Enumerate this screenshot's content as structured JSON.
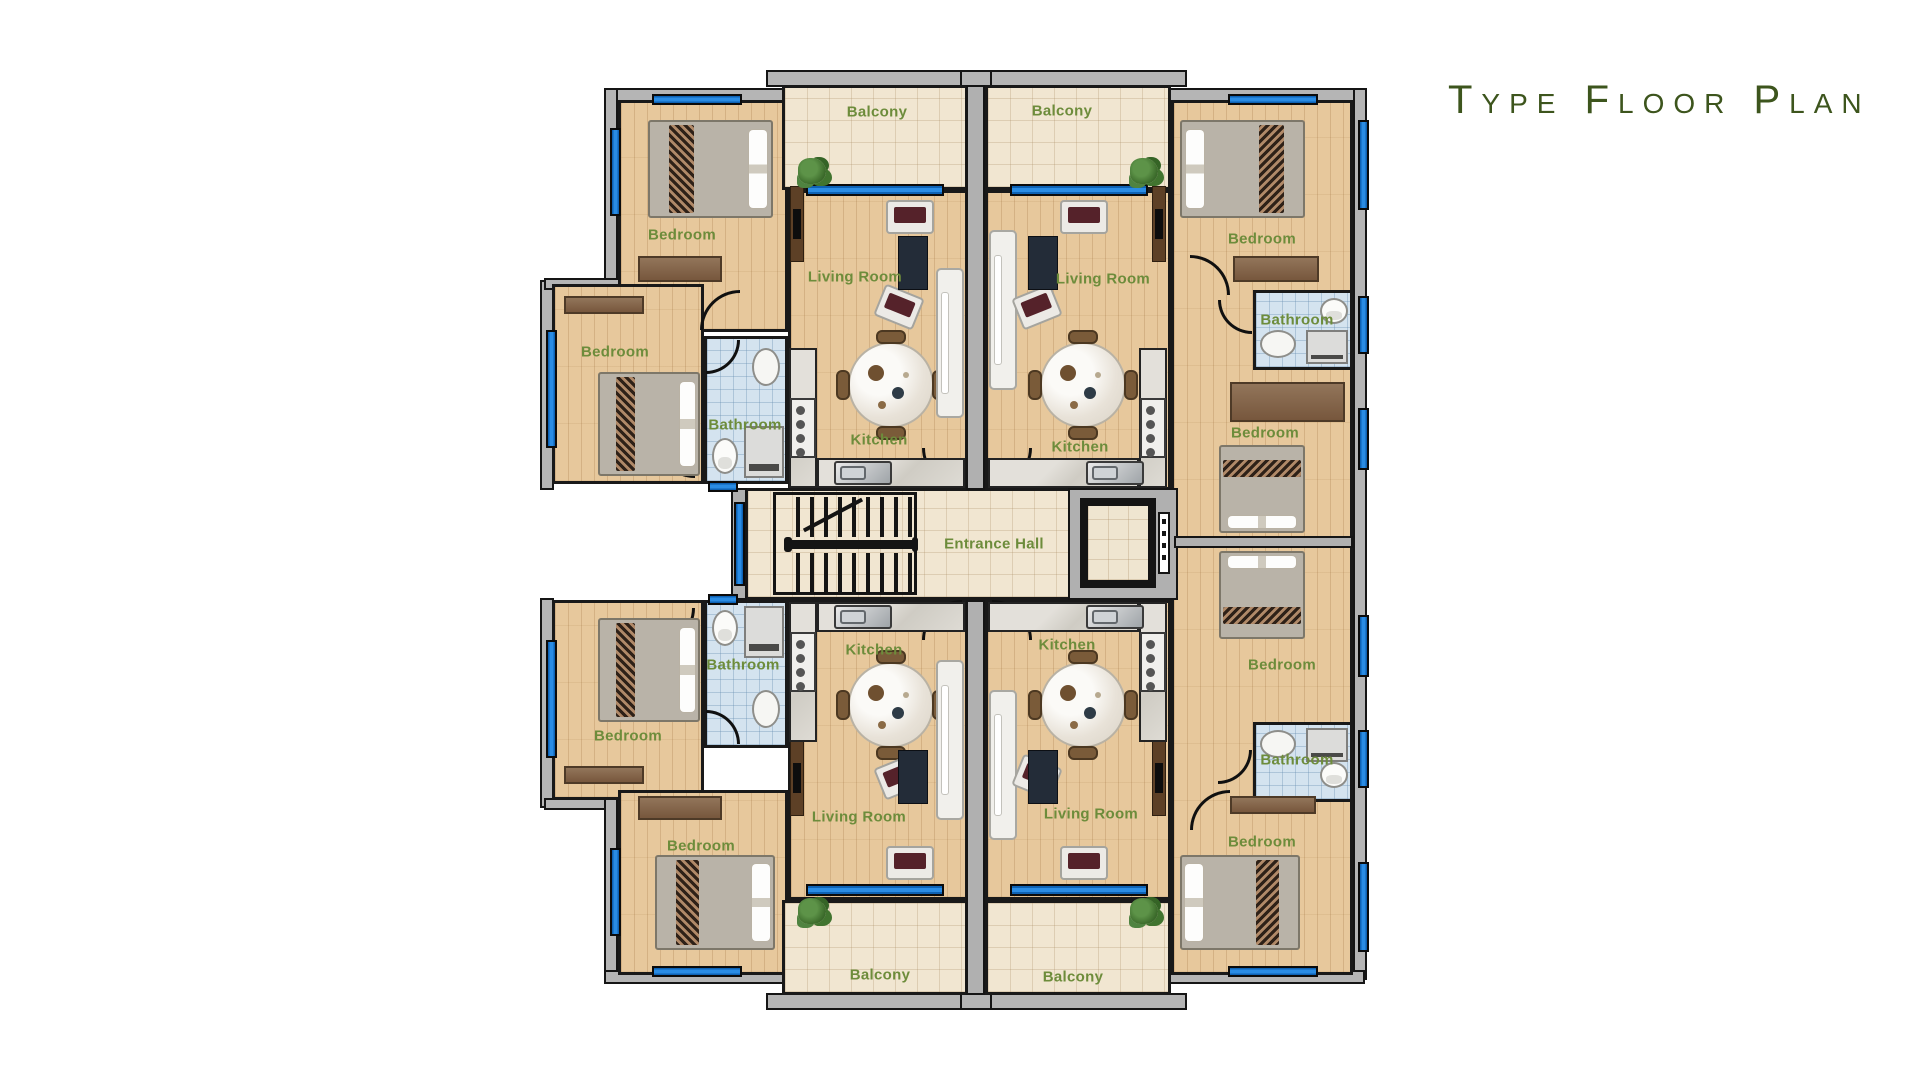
{
  "title": "Type Floor Plan",
  "rooms": {
    "balcony": "Balcony",
    "bedroom": "Bedroom",
    "bathroom": "Bathroom",
    "kitchen": "Kitchen",
    "living_room": "Living Room",
    "entrance_hall": "Entrance Hall"
  },
  "counts": {
    "balconies": 4,
    "bedrooms": 8,
    "bathrooms": 4,
    "kitchens": 4,
    "living_rooms": 4,
    "entrance_halls": 1
  },
  "colors": {
    "label_green": "#6d8c3b",
    "title_green": "#3d551d",
    "window_blue": "#2a8ce4",
    "wood_floor": "#e7c89c",
    "tile_cream": "#f1e6d1",
    "tile_bathroom_blue": "#d4e3ef",
    "wall_gray": "#b5b5b5",
    "wall_black": "#191919"
  }
}
